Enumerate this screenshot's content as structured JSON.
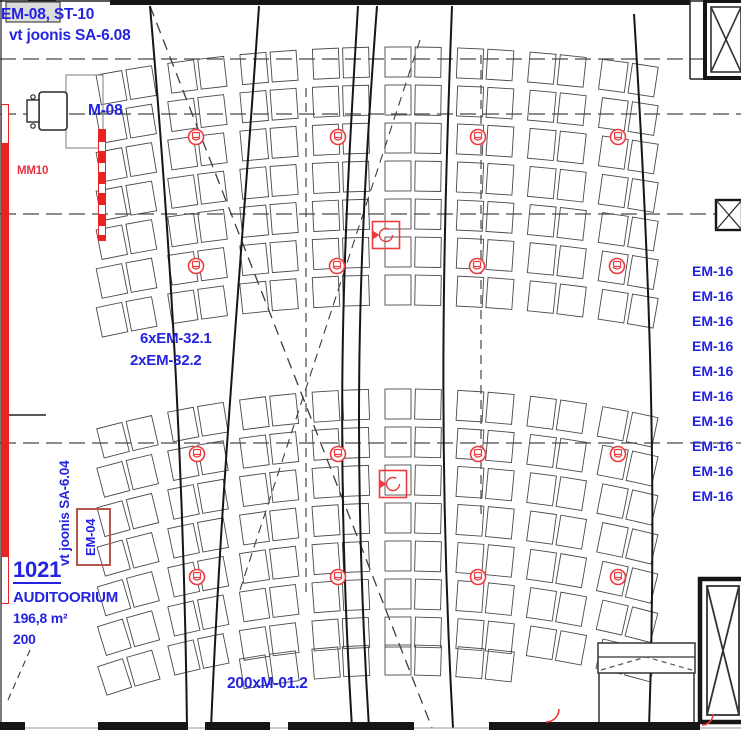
{
  "colors": {
    "blue": "#2424e0",
    "red": "#ee3044",
    "symbol_red": "#ee3a3e",
    "wall_red": "#e82321",
    "line_dark": "#161616"
  },
  "annotations": {
    "top_left": {
      "line1": "EM-08, ST-10",
      "line2": "vt joonis SA-6.08"
    },
    "projector_label": "M-08",
    "wall_label": "MM10",
    "fixture_group": {
      "line1": "6xEM-32.1",
      "line2": "2xEM-32.2"
    },
    "seat_note": "200xM-01.2",
    "door_label": "EM-04",
    "door_ref": "vt joonis SA-6.04",
    "room": {
      "number": "1021",
      "name": "AUDITOORIUM",
      "area": "196,8 m²",
      "capacity": "200"
    }
  },
  "em16_labels": [
    "EM-16",
    "EM-16",
    "EM-16",
    "EM-16",
    "EM-16",
    "EM-16",
    "EM-16",
    "EM-16",
    "EM-16",
    "EM-16"
  ],
  "em16_layout": {
    "first_top": 263,
    "spacing": 25
  },
  "speakers": [
    {
      "x": 196,
      "y": 137
    },
    {
      "x": 338,
      "y": 137
    },
    {
      "x": 478,
      "y": 137
    },
    {
      "x": 618,
      "y": 137
    },
    {
      "x": 196,
      "y": 266
    },
    {
      "x": 337,
      "y": 266
    },
    {
      "x": 477,
      "y": 266
    },
    {
      "x": 617,
      "y": 266
    },
    {
      "x": 197,
      "y": 454
    },
    {
      "x": 338,
      "y": 454
    },
    {
      "x": 478,
      "y": 454
    },
    {
      "x": 618,
      "y": 454
    },
    {
      "x": 197,
      "y": 577
    },
    {
      "x": 338,
      "y": 577
    },
    {
      "x": 478,
      "y": 577
    },
    {
      "x": 618,
      "y": 577
    }
  ],
  "ceiling_fixtures": [
    {
      "x": 386,
      "y": 235
    },
    {
      "x": 393,
      "y": 484
    }
  ]
}
